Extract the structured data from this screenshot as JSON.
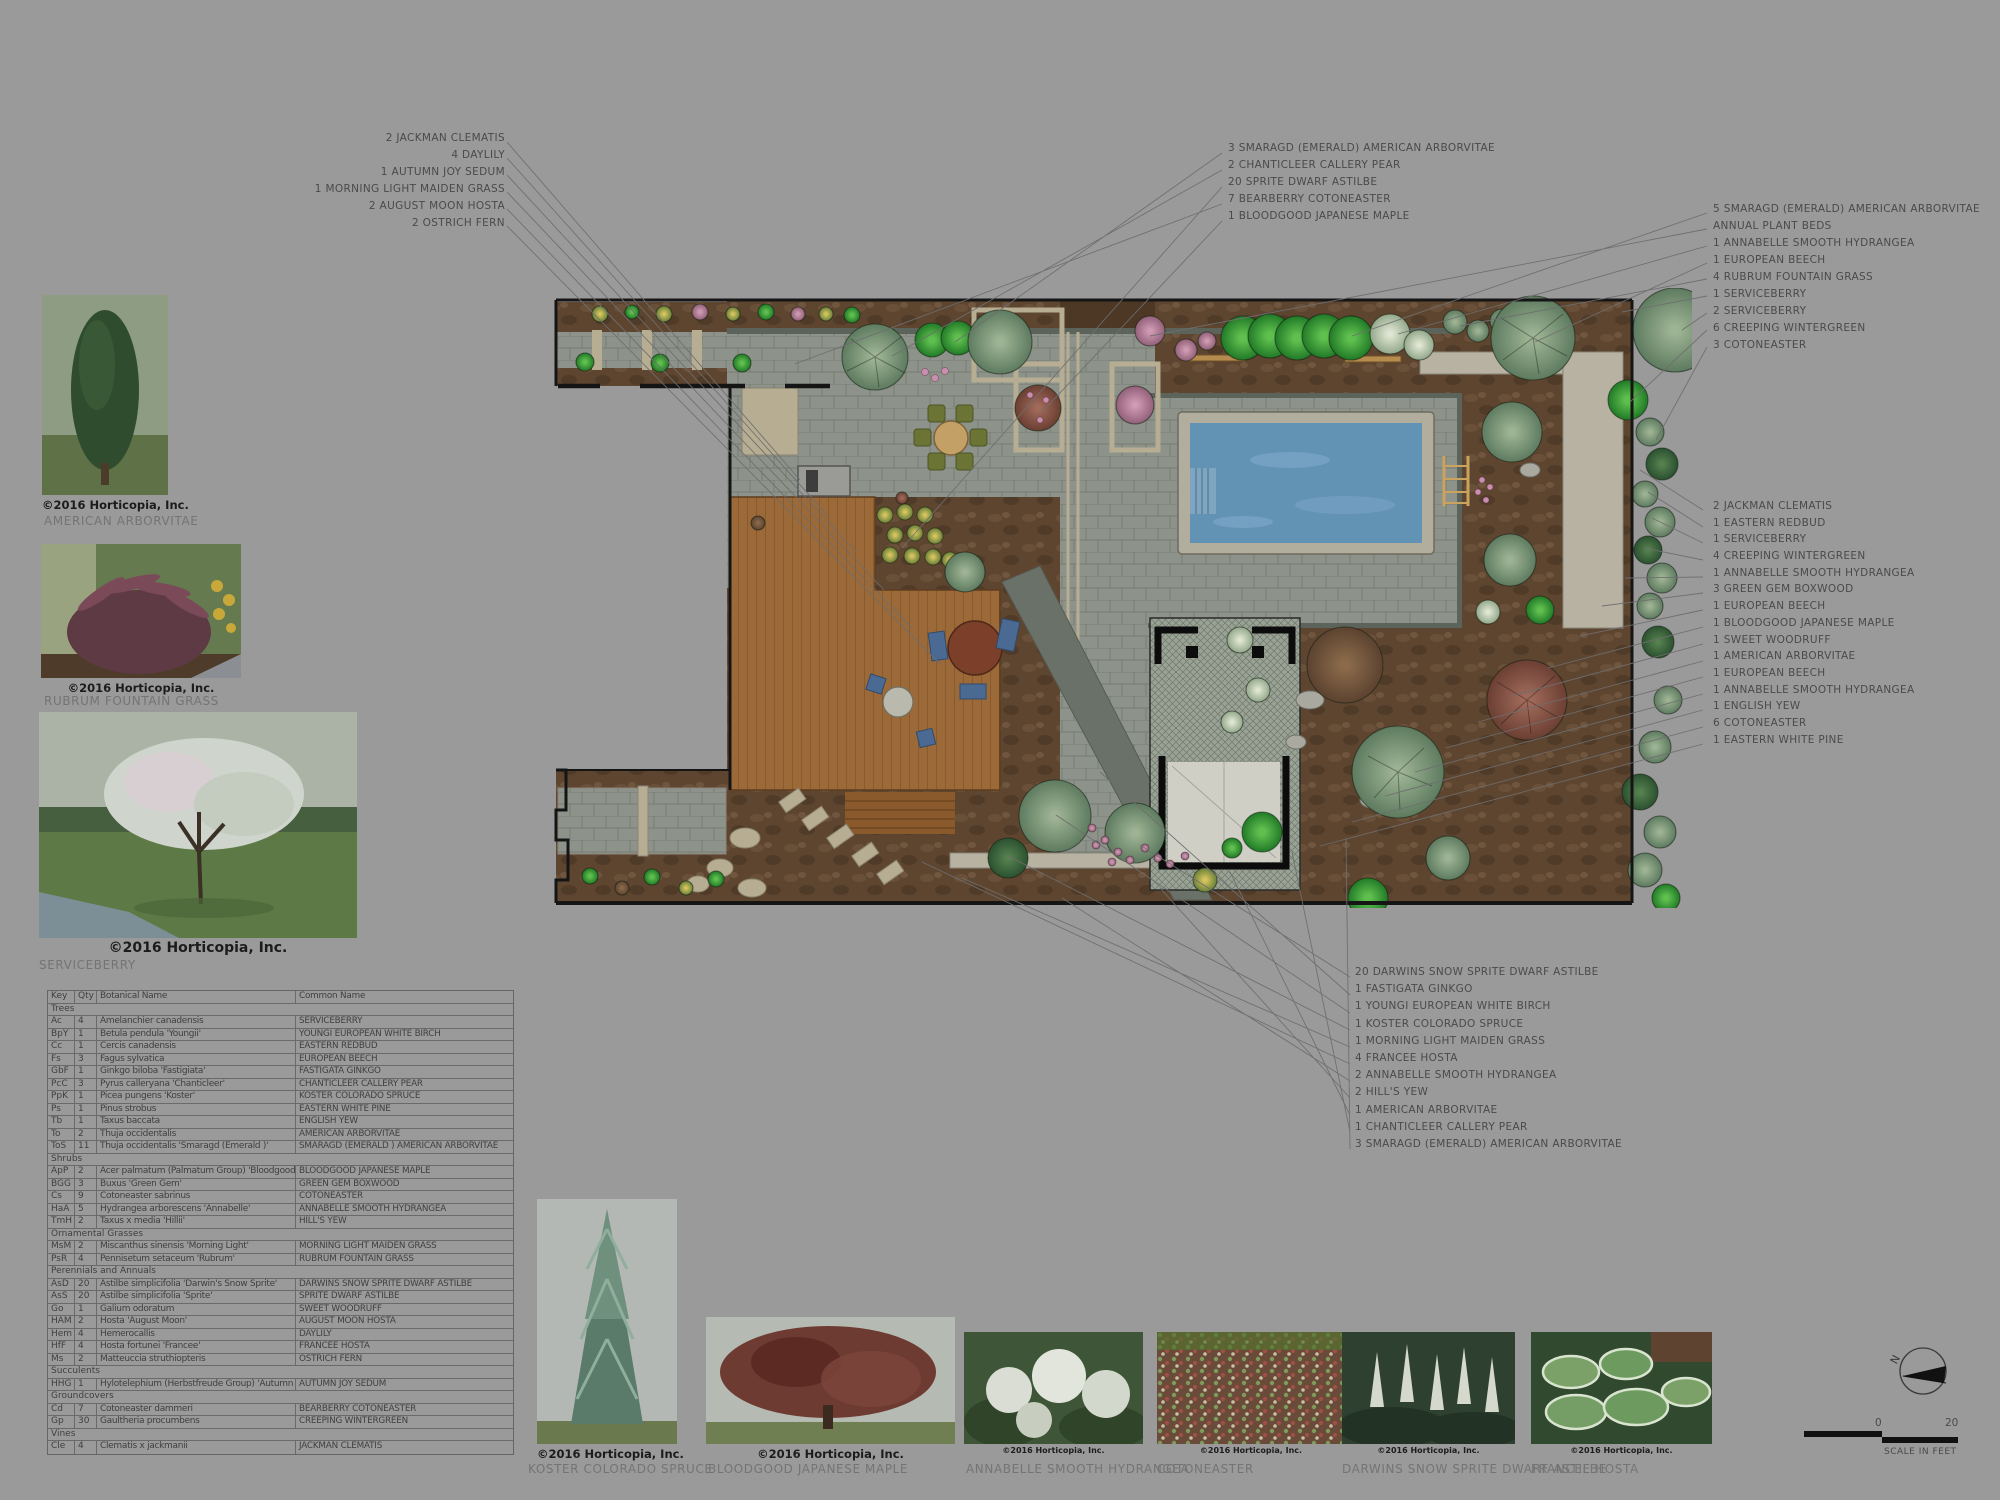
{
  "title": "Residential landscape planting plan",
  "callouts": {
    "top_left": [
      "2 JACKMAN CLEMATIS",
      "4 DAYLILY",
      "1 AUTUMN JOY SEDUM",
      "1 MORNING LIGHT MAIDEN GRASS",
      "2 AUGUST MOON HOSTA",
      "2 OSTRICH FERN"
    ],
    "top_center": [
      "3 SMARAGD (EMERALD) AMERICAN ARBORVITAE",
      "2 CHANTICLEER CALLERY PEAR",
      "20 SPRITE DWARF ASTILBE",
      "7 BEARBERRY COTONEASTER",
      "1 BLOODGOOD JAPANESE MAPLE"
    ],
    "top_right": [
      "5 SMARAGD (EMERALD) AMERICAN ARBORVITAE",
      "ANNUAL PLANT BEDS",
      "1 ANNABELLE SMOOTH HYDRANGEA",
      "1 EUROPEAN BEECH",
      "4 RUBRUM FOUNTAIN GRASS",
      "1 SERVICEBERRY",
      "2 SERVICEBERRY",
      "6 CREEPING WINTERGREEN",
      "3 COTONEASTER"
    ],
    "right": [
      "2 JACKMAN CLEMATIS",
      "1 EASTERN REDBUD",
      "1 SERVICEBERRY",
      "4 CREEPING WINTERGREEN",
      "1 ANNABELLE SMOOTH HYDRANGEA",
      "3 GREEN GEM BOXWOOD",
      "1 EUROPEAN BEECH",
      "1 BLOODGOOD JAPANESE MAPLE",
      "1 SWEET WOODRUFF",
      "1 AMERICAN ARBORVITAE",
      "1 EUROPEAN BEECH",
      "1 ANNABELLE SMOOTH HYDRANGEA",
      "1 ENGLISH YEW",
      "6 COTONEASTER",
      "1 EASTERN WHITE PINE"
    ],
    "bottom": [
      "20 DARWINS SNOW SPRITE DWARF ASTILBE",
      "1 FASTIGATA GINKGO",
      "1 YOUNGI EUROPEAN WHITE BIRCH",
      "1 KOSTER COLORADO SPRUCE",
      "1 MORNING LIGHT MAIDEN GRASS",
      "4 FRANCEE HOSTA",
      "2 ANNABELLE SMOOTH HYDRANGEA",
      "2 HILL'S YEW",
      "1 AMERICAN ARBORVITAE",
      "1 CHANTICLEER CALLERY PEAR",
      "3 SMARAGD (EMERALD) AMERICAN ARBORVITAE"
    ]
  },
  "left_photos": [
    {
      "label": "AMERICAN ARBORVITAE",
      "credit": "©2016 Horticopia, Inc."
    },
    {
      "label": "RUBRUM FOUNTAIN GRASS",
      "credit": "©2016 Horticopia, Inc."
    },
    {
      "label": "SERVICEBERRY",
      "credit": "©2016 Horticopia, Inc."
    }
  ],
  "bottom_photos": [
    {
      "label": "KOSTER COLORADO SPRUCE",
      "credit": "©2016 Horticopia, Inc."
    },
    {
      "label": "BLOODGOOD JAPANESE MAPLE",
      "credit": "©2016 Horticopia, Inc."
    },
    {
      "label": "ANNABELLE SMOOTH HYDRANGEA",
      "credit": "©2016 Horticopia, Inc."
    },
    {
      "label": "COTONEASTER",
      "credit": "©2016 Horticopia, Inc."
    },
    {
      "label": "DARWINS SNOW SPRITE DWARF ASTILBE",
      "credit": "©2016 Horticopia, Inc."
    },
    {
      "label": "FRANCEE HOSTA",
      "credit": "©2016 Horticopia, Inc."
    }
  ],
  "schedule": {
    "headers": [
      "Key",
      "Qty",
      "Botanical Name",
      "Common Name"
    ],
    "rows": [
      {
        "label": "Trees"
      },
      {
        "key": "Ac",
        "qty": "4",
        "bot": "Amelanchier canadensis",
        "common": "SERVICEBERRY"
      },
      {
        "key": "BpY",
        "qty": "1",
        "bot": "Betula pendula 'Youngii'",
        "common": "YOUNGI EUROPEAN WHITE BIRCH"
      },
      {
        "key": "Cc",
        "qty": "1",
        "bot": "Cercis canadensis",
        "common": "EASTERN REDBUD"
      },
      {
        "key": "Fs",
        "qty": "3",
        "bot": "Fagus sylvatica",
        "common": "EUROPEAN BEECH"
      },
      {
        "key": "GbF",
        "qty": "1",
        "bot": "Ginkgo biloba 'Fastigiata'",
        "common": "FASTIGATA GINKGO"
      },
      {
        "key": "PcC",
        "qty": "3",
        "bot": "Pyrus calleryana 'Chanticleer'",
        "common": "CHANTICLEER CALLERY PEAR"
      },
      {
        "key": "PpK",
        "qty": "1",
        "bot": "Picea pungens 'Koster'",
        "common": "KOSTER COLORADO SPRUCE"
      },
      {
        "key": "Ps",
        "qty": "1",
        "bot": "Pinus strobus",
        "common": "EASTERN WHITE PINE"
      },
      {
        "key": "Tb",
        "qty": "1",
        "bot": "Taxus baccata",
        "common": "ENGLISH YEW"
      },
      {
        "key": "To",
        "qty": "2",
        "bot": "Thuja occidentalis",
        "common": "AMERICAN ARBORVITAE"
      },
      {
        "key": "ToS",
        "qty": "11",
        "bot": "Thuja occidentalis 'Smaragd (Emerald )'",
        "common": "SMARAGD (EMERALD ) AMERICAN ARBORVITAE"
      },
      {
        "label": "Shrubs"
      },
      {
        "key": "ApP",
        "qty": "2",
        "bot": "Acer palmatum (Palmatum Group) 'Bloodgood'",
        "common": "BLOODGOOD JAPANESE MAPLE"
      },
      {
        "key": "BGG",
        "qty": "3",
        "bot": "Buxus 'Green Gem'",
        "common": "GREEN GEM BOXWOOD"
      },
      {
        "key": "Cs",
        "qty": "9",
        "bot": "Cotoneaster sabrinus",
        "common": "COTONEASTER"
      },
      {
        "key": "HaA",
        "qty": "5",
        "bot": "Hydrangea arborescens 'Annabelle'",
        "common": "ANNABELLE SMOOTH HYDRANGEA"
      },
      {
        "key": "TmH",
        "qty": "2",
        "bot": "Taxus x media 'Hillii'",
        "common": "HILL'S YEW"
      },
      {
        "label": "Ornamental Grasses"
      },
      {
        "key": "MsM",
        "qty": "2",
        "bot": "Miscanthus sinensis 'Morning Light'",
        "common": "MORNING LIGHT MAIDEN GRASS"
      },
      {
        "key": "PsR",
        "qty": "4",
        "bot": "Pennisetum setaceum 'Rubrum'",
        "common": "RUBRUM FOUNTAIN GRASS"
      },
      {
        "label": "Perennials and Annuals"
      },
      {
        "key": "AsD",
        "qty": "20",
        "bot": "Astilbe simplicifolia 'Darwin's Snow Sprite'",
        "common": "DARWINS SNOW SPRITE DWARF ASTILBE"
      },
      {
        "key": "AsS",
        "qty": "20",
        "bot": "Astilbe simplicifolia 'Sprite'",
        "common": "SPRITE DWARF ASTILBE"
      },
      {
        "key": "Go",
        "qty": "1",
        "bot": "Galium odoratum",
        "common": "SWEET WOODRUFF"
      },
      {
        "key": "HAM",
        "qty": "2",
        "bot": "Hosta 'August Moon'",
        "common": "AUGUST MOON HOSTA"
      },
      {
        "key": "Hem",
        "qty": "4",
        "bot": "Hemerocallis",
        "common": "DAYLILY"
      },
      {
        "key": "HfF",
        "qty": "4",
        "bot": "Hosta fortunei 'Francee'",
        "common": "FRANCEE HOSTA"
      },
      {
        "key": "Ms",
        "qty": "2",
        "bot": "Matteuccia struthiopteris",
        "common": "OSTRICH FERN"
      },
      {
        "label": "Succulents"
      },
      {
        "key": "HHG",
        "qty": "1",
        "bot": "Hylotelephium (Herbstfreude Group) 'Autumn Joy'",
        "common": "AUTUMN JOY SEDUM"
      },
      {
        "label": "Groundcovers"
      },
      {
        "key": "Cd",
        "qty": "7",
        "bot": "Cotoneaster dammeri",
        "common": "BEARBERRY COTONEASTER"
      },
      {
        "key": "Gp",
        "qty": "30",
        "bot": "Gaultheria procumbens",
        "common": "CREEPING WINTERGREEN"
      },
      {
        "label": "Vines"
      },
      {
        "key": "Cle",
        "qty": "4",
        "bot": "Clematis x jackmanii",
        "common": "JACKMAN CLEMATIS"
      }
    ]
  },
  "compass": {
    "north_label": "N"
  },
  "scale_bar": {
    "tick_zero": "0",
    "tick_twenty": "20",
    "caption": "SCALE IN FEET"
  },
  "colors": {
    "background": "#9a9a9a",
    "mulch": "#5e4530",
    "pavers": "#8d938a",
    "pool_water": "#6292b4",
    "deck_wood": "#9c6a38",
    "bright_foliage": "#2f9a33",
    "sage_foliage": "#7a9b78",
    "property_line": "#151515",
    "callout_text": "#4a4a4a"
  }
}
